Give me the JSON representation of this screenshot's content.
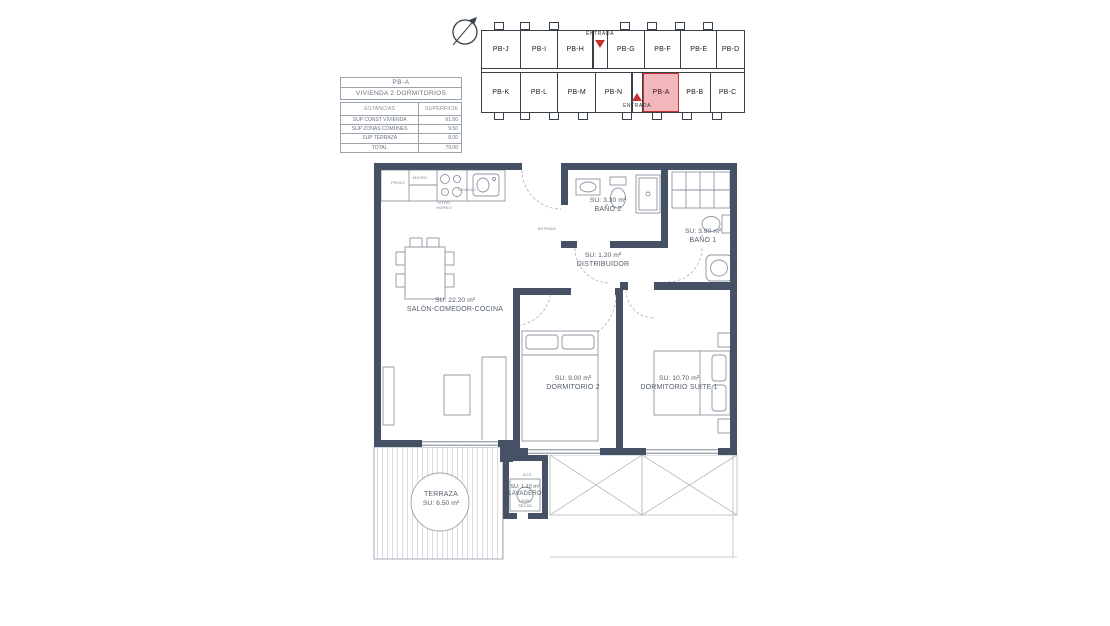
{
  "colors": {
    "wall": "#475166",
    "accent_red": "#c43131",
    "highlight_fill": "#f2b7ba",
    "thin_line": "#a7aeb8"
  },
  "summary_table": {
    "unit": "PB-A",
    "dwelling_type": "VIVIENDA 2 DORMITORIOS",
    "col_rooms": "ESTANCIAS",
    "col_area": "SUPERFICIE",
    "rows": [
      {
        "label": "SUP CONST VIVIENDA",
        "value": "61.50"
      },
      {
        "label": "SUP ZONAS COMUNES",
        "value": "9.50"
      },
      {
        "label": "SUP TERRAZA",
        "value": "8.00"
      },
      {
        "label": "TOTAL",
        "value": "79.00"
      }
    ]
  },
  "keyplan": {
    "entrada_top": "ENTRADA",
    "entrada_bottom": "ENTRADA",
    "highlighted_unit": "PB-A",
    "top_row": [
      "PB-J",
      "PB-I",
      "PB-H",
      "PB-G",
      "PB-F",
      "PB-E",
      "PB-D"
    ],
    "bottom_row": [
      "PB-K",
      "PB-L",
      "PB-M",
      "PB-N",
      "PB-A",
      "PB-B",
      "PB-C"
    ]
  },
  "floorplan": {
    "rooms": [
      {
        "id": "salon",
        "area": "SU: 22.20 m²",
        "name": "SALÓN-COMEDOR-COCINA"
      },
      {
        "id": "bano2",
        "area": "SU: 3.30 m²",
        "name": "BAÑO 2"
      },
      {
        "id": "bano1",
        "area": "SU: 3.90 m²",
        "name": "BAÑO 1"
      },
      {
        "id": "distribuidor",
        "area": "SU: 1.20 m²",
        "name": "DISTRIBUIDOR"
      },
      {
        "id": "dormitorio2",
        "area": "SU: 9.00 m²",
        "name": "DORMITORIO 2"
      },
      {
        "id": "suite1",
        "area": "SU: 10.70 m²",
        "name": "DORMITORIO SUITE 1"
      },
      {
        "id": "terraza",
        "area": "SU: 6.50 m²",
        "name": "TERRAZA"
      },
      {
        "id": "lavadero",
        "area": "SU: 1.10 m²",
        "name": "LAVADERO"
      }
    ],
    "labels": {
      "frigo": "FRIGO",
      "micro": "MICRO",
      "lavavaj": "LAVAVAJ",
      "vitro": "VITRO",
      "horno": "HORNO",
      "lavad": "LAVAD",
      "secad": "SECAD",
      "acs": "ACS",
      "entrada": "ENTRADA"
    }
  }
}
